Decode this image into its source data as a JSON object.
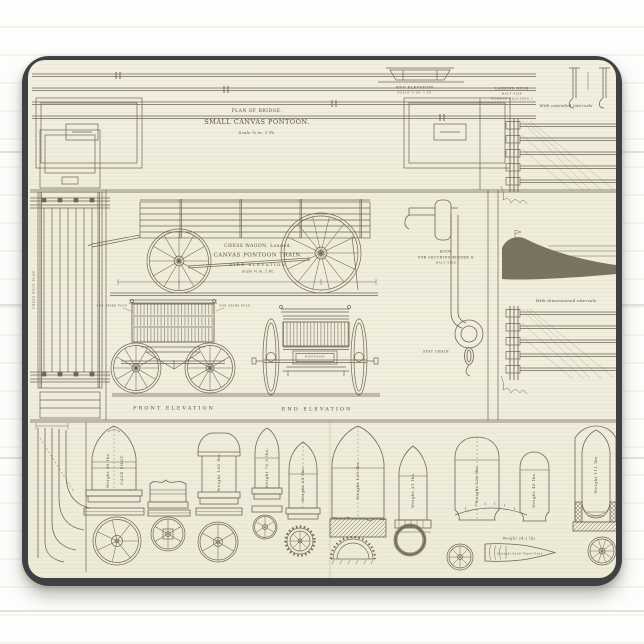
{
  "scene": {
    "pad_color": "#3e4043",
    "paper_color": "#f0eddc",
    "ink_color": "#6e6756",
    "background_color": "#fbfbf9"
  },
  "plate": {
    "top_plan": {
      "line1": "PLAN OF BRIDGE.",
      "line2": "SMALL CANVAS PONTOON.",
      "scale": "Scale ¾ in. 1 Ft."
    },
    "top_right": {
      "end_elevation": "END ELEVATION",
      "end_elevation_scale": "SCALE ¾ IN. 1 FT.",
      "lashing_hook": "LASHING HOOK",
      "lashing_hook_size": "HALF SIZE",
      "lashing_hook_number": "NUMBER REQUIRED 2"
    },
    "right_column": {
      "caption_top": "With extended intervals",
      "caption_mid": "With dimensioned intervals"
    },
    "left_column": {
      "vertical_label": "CHESS DECK PLAN"
    },
    "wagon": {
      "line1": "CHESS WAGON, Loaded.",
      "line2": "CANVAS PONTOON TRAIN.",
      "line3": "SIDE ELEVATION",
      "scale": "Scale ¾ in. 1 Ft.",
      "front_label": "FRONT ELEVATION",
      "end_label": "END ELEVATION",
      "spare_pole_left": "FOR SPARE POLE",
      "spare_pole_right": "FOR SPARE POLE",
      "pontoon_label": "PONTOON"
    },
    "hook": {
      "line1": "HOOK",
      "line2": "FOR SECURING BINDER &",
      "line3": "HALF SIZE",
      "stay_chain": "STAY CHAIN"
    },
    "shells": [
      {
        "weight": "Weight 98 lbs.",
        "note": "CASE SHOT"
      },
      {
        "weight": ""
      },
      {
        "weight": "Weight 100 lbs."
      },
      {
        "weight": "Weight 70.5 lbs."
      },
      {
        "weight": "Weight 25 lbs."
      },
      {
        "weight": "Weight 165 lbs."
      },
      {
        "weight": "Weight 25 lbs."
      },
      {
        "weight": "Weight 120 lbs."
      },
      {
        "weight": "Weight 40 lbs."
      },
      {
        "weight": "Weight 111 lbs."
      }
    ],
    "schenkl": {
      "line1": "Weight 24.2 lbs.",
      "line2": "Schenkl Shell Paper Fuze"
    }
  }
}
